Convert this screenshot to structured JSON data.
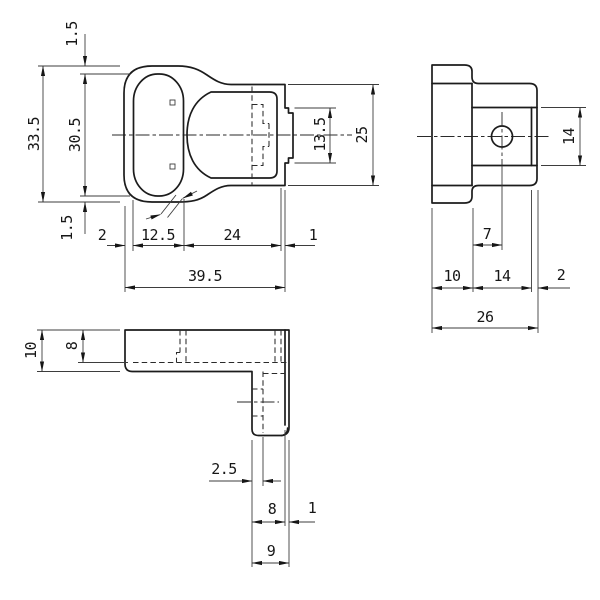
{
  "drawing": {
    "type": "engineering-orthographic-drawing",
    "background": "#ffffff",
    "line_color": "#1c1c1c",
    "thin_line_color": "#3d3d3d",
    "views": {
      "front": {
        "title": "front-view",
        "dims": {
          "top_wall": "1.5",
          "overall_height": "33.5",
          "ring_inner_height": "30.5",
          "bottom_wall": "1.5",
          "left_wall": "2",
          "ring_inner_width": "12.5",
          "cavity_width": "24",
          "right_wall": "1",
          "overall_width": "39.5",
          "tab_height": "13.5",
          "body_height": "25"
        }
      },
      "side": {
        "title": "side-view",
        "dims": {
          "block_height": "14",
          "hole_offset": "7",
          "flange_depth": "10",
          "block_depth": "14",
          "lip_depth": "2",
          "overall_depth": "26"
        }
      },
      "bottom": {
        "title": "bottom-view",
        "dims": {
          "bar_depth": "10",
          "bar_inner_depth": "8",
          "leg_wall": "2.5",
          "leg_inner_width": "8",
          "leg_lip": "1",
          "leg_width": "9"
        }
      }
    }
  }
}
